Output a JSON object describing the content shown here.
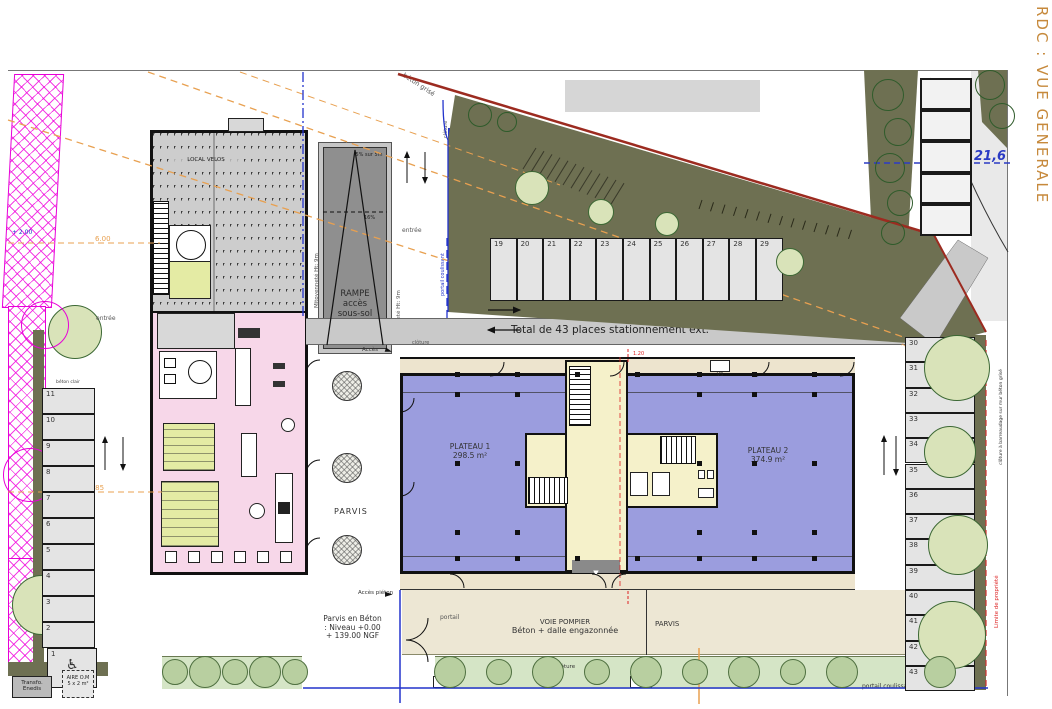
{
  "title": "RDC : VUE GENERALE",
  "site": {
    "property_line_label": "Ligne de propriété",
    "talus_label": "TALUS",
    "retaining_wall_label": "mur soutènement Ht: 1.60m",
    "beton_grise_label": "béton grisé",
    "fence_label_road": "clôture",
    "fence_label_gate": "clôture",
    "fence_label_hedge": "clôture",
    "fence_label_bottom_right": "clôture",
    "sliding_gate_label_top": "portail coulissant",
    "sliding_gate_label_bottom": "portail coulissant",
    "gate_label": "portail",
    "entrance_label_top": "entrée",
    "entrance_label_left": "entrée",
    "access_label": "Accès",
    "pedestrian_access_label": "Accès piéton",
    "road_level_label": "139.00 NGF",
    "limit_label": "Limite de propriété",
    "fence_detail_label": "clôture à barreaudage sur mur béton grisé",
    "neighbor_level": "21,6"
  },
  "dimensions": {
    "d_6_00": "6.00",
    "d_12_85": "12.85",
    "d_12_05": "12.05",
    "d_10_50": "10.50",
    "d_2_00": "+ 2.00",
    "d_1_20_top": "1.20",
    "d_1_20_bottom": "1.20"
  },
  "parking": {
    "total_label": "Total de 43 places stationnement ext.",
    "surface_label_top": "béton clair",
    "surface_label_left": "béton clair",
    "surface_label_right": "béton clair",
    "top_row": [
      "19",
      "20",
      "21",
      "22",
      "23",
      "24",
      "25",
      "26",
      "27",
      "28",
      "29"
    ],
    "right_column": [
      "30",
      "31",
      "32",
      "33",
      "34",
      "35",
      "36",
      "37",
      "38",
      "39",
      "40",
      "41",
      "42",
      "43"
    ],
    "left_column": [
      "11",
      "10",
      "9",
      "8",
      "7",
      "6",
      "5",
      "4",
      "3",
      "2"
    ],
    "handicap_space": "1",
    "handicap_icon": "♿"
  },
  "ramp": {
    "line1": "RAMPE",
    "line2": "accès",
    "line3": "sous-sol",
    "slope_top": "5% sur 5m",
    "slope_main": "16%",
    "party_wall_label_left": "Mitoyenneté Ht: 9m",
    "party_wall_label_right": "Mitoyenneté Ht: 9m"
  },
  "annex_building": {
    "bike_room_label": "LOCAL VELOS"
  },
  "main_building": {
    "plateau1_name": "PLATEAU 1",
    "plateau1_area": "298.5 m²",
    "plateau2_name": "PLATEAU 2",
    "plateau2_area": "374.9 m²",
    "access_line1": "accès",
    "access_line2": "accueil bureaux",
    "vs_label": "VS",
    "entry_arrow": "▼"
  },
  "green_roof": {
    "line1": "TOIT VEGETAL",
    "line2": "LOCAL 2 ROUES",
    "line3": "Local béton",
    "line4": "44.3 m²"
  },
  "south_area": {
    "parvis_label_strip": "PARVIS",
    "parvis_label_right": "PARVIS",
    "parvis_beton_line1": "Parvis en Béton",
    "parvis_beton_line2": ": Niveau +0.00",
    "parvis_beton_line3": "+ 139.00 NGF",
    "fire_lane_line1": "VOIE POMPIER",
    "fire_lane_line2": "Béton + dalle engazonnée"
  },
  "utilities": {
    "transfo_line1": "Transfo.",
    "transfo_line2": "Enedis",
    "waste_line1": "AIRE O.M",
    "waste_line2": "5 x 2 m²"
  },
  "arrows": {
    "pedestrian_arrow": "►",
    "access_arrow": "►"
  },
  "colors": {
    "title_orange": "#C6893B",
    "plateau_blue": "#9B9DDE",
    "core_cream": "#F5F1CA",
    "annex_pink": "#F7D7E9",
    "olive_green": "#6E7052",
    "property_line_red": "#9C2B20",
    "survey_orange": "#E8A050",
    "boundary_blue": "#2233CC",
    "magenta": "#F000DC"
  }
}
